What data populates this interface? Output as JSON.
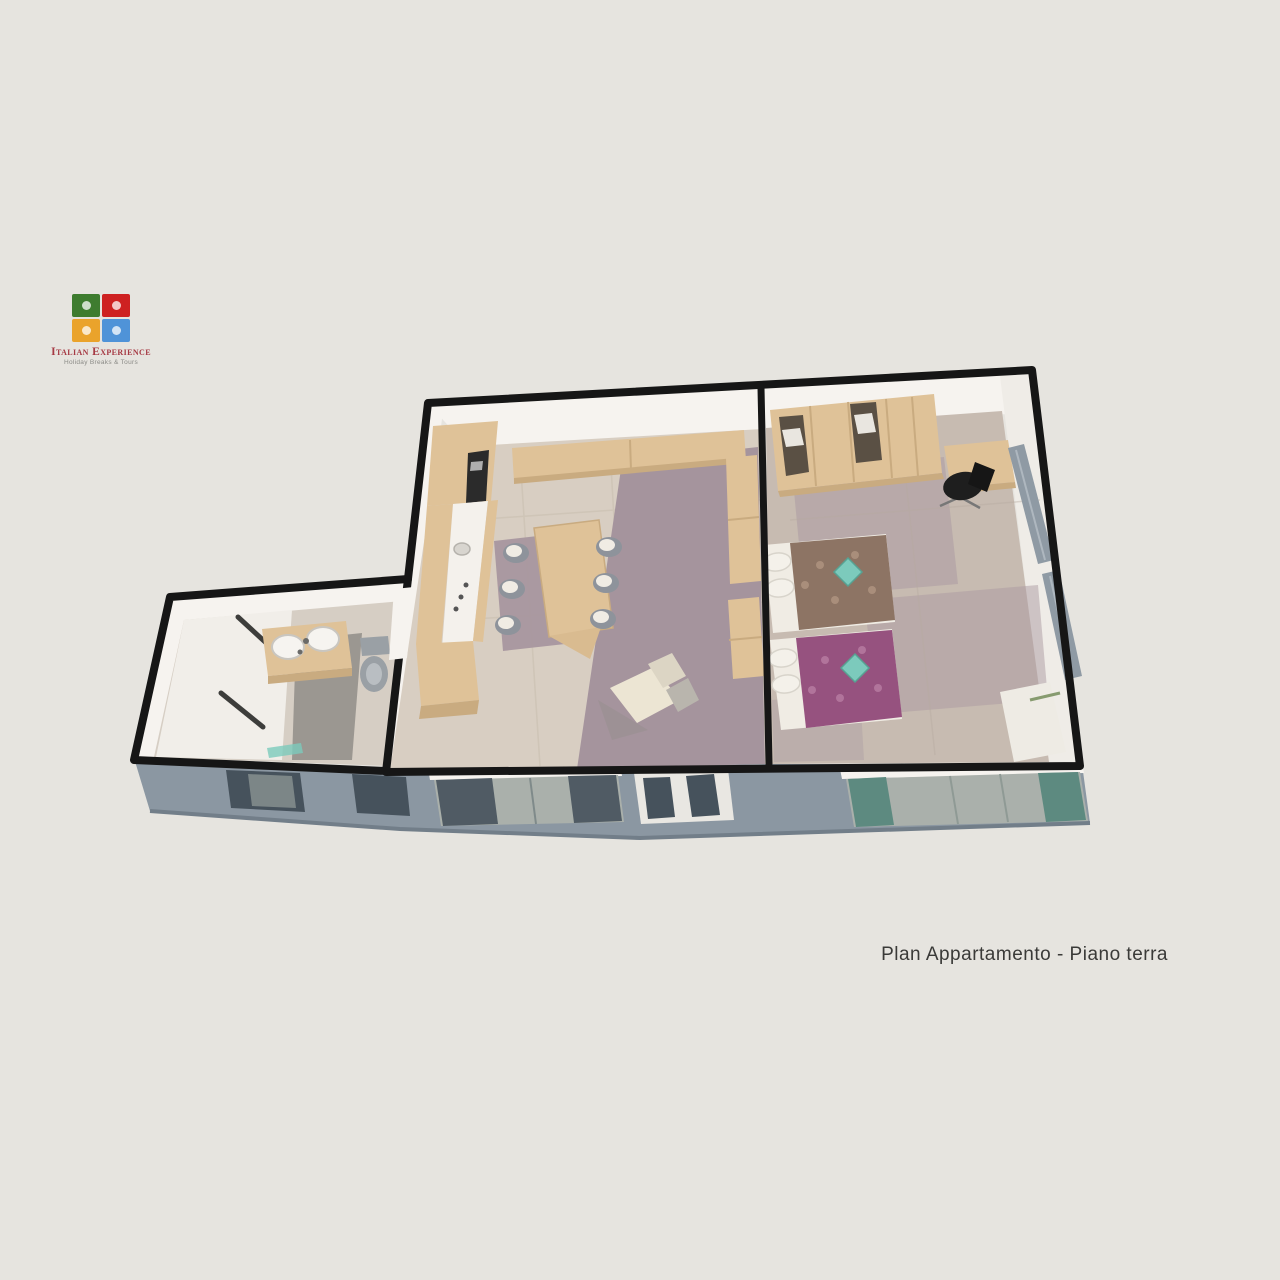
{
  "page": {
    "background": "#e6e4df"
  },
  "logo": {
    "title": "Italian Experience",
    "tagline": "Holiday Breaks & Tours",
    "title_color": "#a63a44",
    "pieces": [
      {
        "name": "puzzle-piece-green",
        "color": "#3e7c2f"
      },
      {
        "name": "puzzle-piece-red",
        "color": "#ce2121"
      },
      {
        "name": "puzzle-piece-yellow",
        "color": "#eaa32b"
      },
      {
        "name": "puzzle-piece-blue",
        "color": "#4f93d8"
      }
    ]
  },
  "caption": {
    "text": "Plan Appartamento - Piano terra",
    "color": "#3a3a38"
  },
  "floorplan": {
    "type": "3d-isometric-floor-plan-render",
    "rooms": [
      {
        "name": "bathroom",
        "furniture": [
          "double-basin vanity",
          "toilet",
          "shower enclosure",
          "teal bath mat"
        ]
      },
      {
        "name": "kitchen-living-room",
        "furniture": [
          "kitchen unit with white counter",
          "tv niche",
          "wall shelf",
          "dining table",
          "six chairs",
          "sideboard",
          "armchair"
        ]
      },
      {
        "name": "bedroom",
        "furniture": [
          "wardrobe",
          "desk",
          "black office chair",
          "single bed brown cover",
          "single bed purple cover",
          "radiators",
          "white quilt"
        ]
      }
    ],
    "palette": {
      "wall_outline": "#161616",
      "wall_face": "#f6f3ef",
      "floor_tile": "#d8cec2",
      "carpet_mauve": "#a5949d",
      "floor_bedroom": "#c7bbb1",
      "floor_bathroom": "#d6cec4",
      "wood": "#dfc298",
      "wood_dark": "#c9ab80",
      "facade": "#8b97a2",
      "facade_edge": "#727e89",
      "glass_dark": "#46525c",
      "glass_light": "#aab0ab",
      "curtain_teal": "#5d8a80",
      "bed_brown": "#8d7464",
      "bed_purple": "#96527f",
      "pillow": "#f0ece4",
      "cushion_teal": "#7ccabc",
      "chair_gray": "#8e939b",
      "office_chair": "#1e1e1e",
      "counter_white": "#f4f1ec",
      "fixture_gray": "#9aa0a5"
    }
  }
}
